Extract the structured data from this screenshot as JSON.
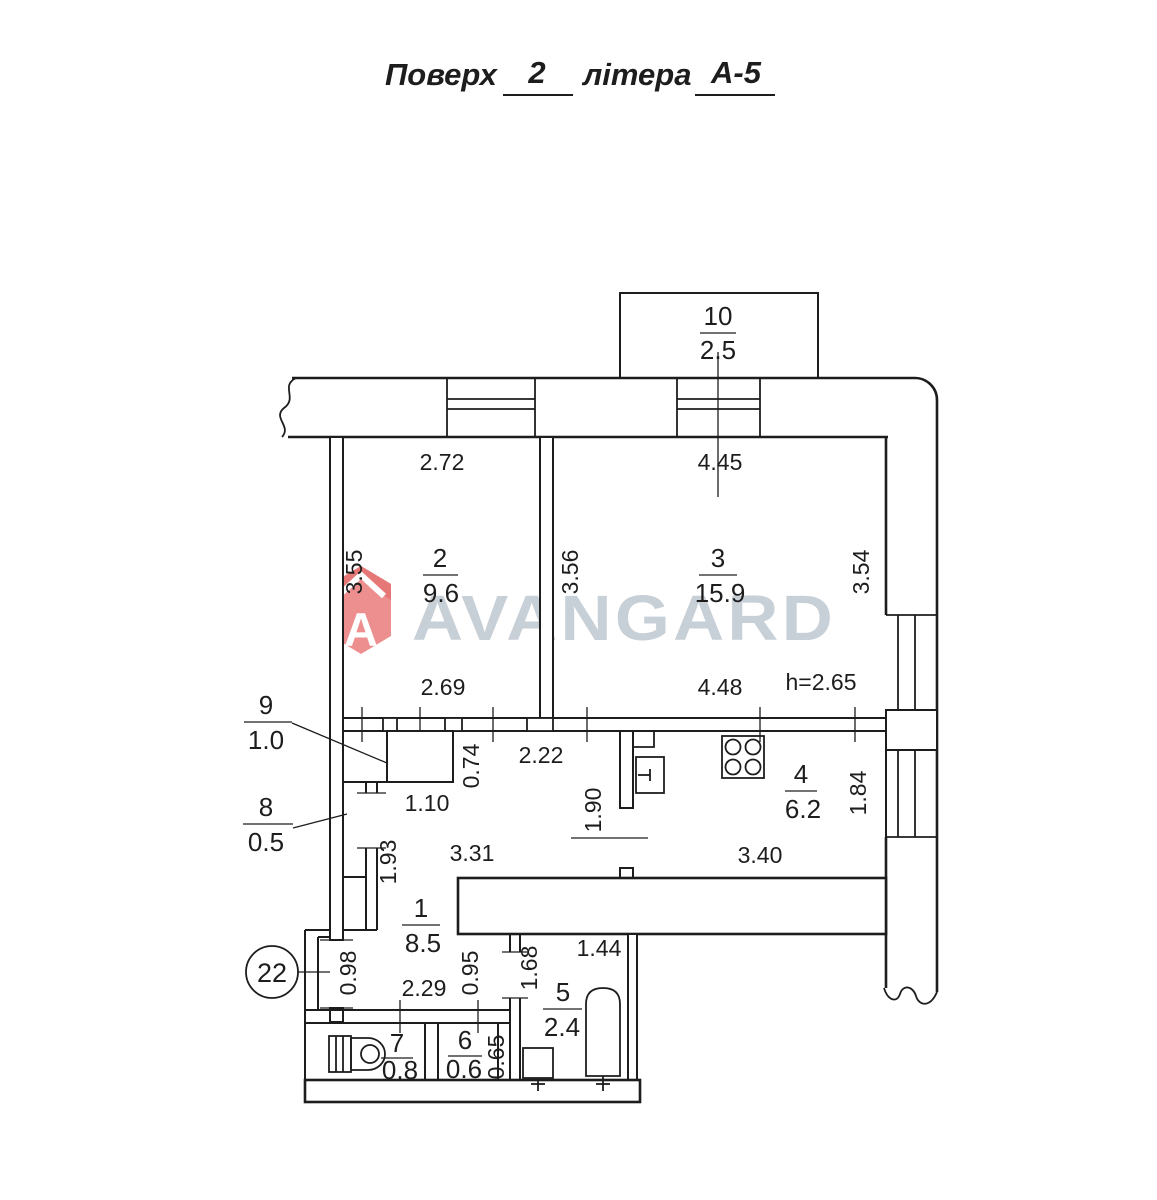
{
  "title": {
    "word1": "Поверх",
    "floor": "2",
    "word2": "літера",
    "letter": "А-5"
  },
  "watermark": {
    "brand": "AVANGARD",
    "logo_letter": "A",
    "logo_color": "#ee8a8a",
    "text_color": "#c5cdd5"
  },
  "apartment_badge": "22",
  "ceiling_height": "h=2.65",
  "colors": {
    "line": "#1d1d1d",
    "background": "#ffffff"
  },
  "fixtures": [
    "stove-icon",
    "kitchen-sink-icon",
    "toilet-icon",
    "bathtub-icon",
    "bath-sink-icon"
  ],
  "rooms": {
    "r1": {
      "number": "1",
      "area": "8.5"
    },
    "r2": {
      "number": "2",
      "area": "9.6"
    },
    "r3": {
      "number": "3",
      "area": "15.9"
    },
    "r4": {
      "number": "4",
      "area": "6.2"
    },
    "r5": {
      "number": "5",
      "area": "2.4"
    },
    "r6": {
      "number": "6",
      "area": "0.6"
    },
    "r7": {
      "number": "7",
      "area": "0.8"
    },
    "r8": {
      "number": "8",
      "area": "0.5"
    },
    "r9": {
      "number": "9",
      "area": "1.0"
    },
    "r10": {
      "number": "10",
      "area": "2.5"
    }
  },
  "dims": {
    "room2_top": "2.72",
    "room2_left": "3.55",
    "room2_bottom": "2.69",
    "room3_top": "4.45",
    "room3_left": "3.56",
    "room3_right": "3.54",
    "room3_bottom": "4.48",
    "closet_depth": "0.74",
    "hall_top": "2.22",
    "closet_width": "1.10",
    "niche_height": "1.93",
    "hall_width": "3.31",
    "kitchen_door": "1.90",
    "kitchen_bottom": "3.40",
    "kitchen_right": "1.84",
    "entry_height": "0.98",
    "entry_width": "2.29",
    "passage_height": "0.95",
    "bath_left": "1.68",
    "bath_top": "1.44",
    "wc_right": "0.65"
  }
}
